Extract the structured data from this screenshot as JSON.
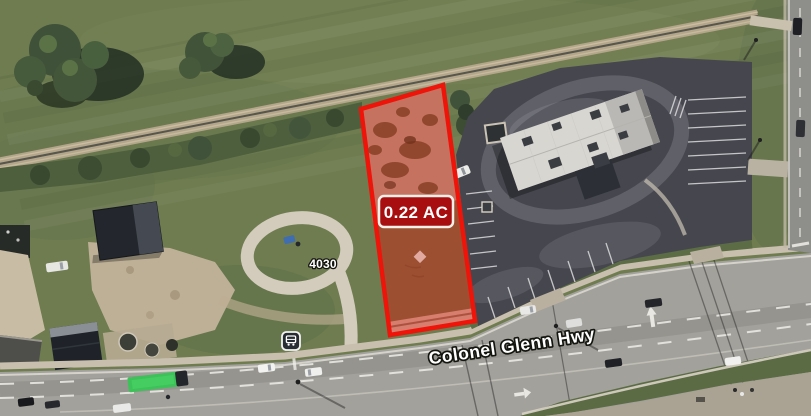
{
  "map": {
    "street_label": "Colonel Glenn Hwy",
    "address_label": "4030",
    "parcel": {
      "area_label": "0.22 AC"
    },
    "colors": {
      "parcel_outline": "#ee1409",
      "parcel_fill_tint": "rgba(237,28,17,0.18)",
      "area_label_bg": "#a80e10",
      "area_label_border": "#f3efe9",
      "area_label_text": "#ffffff"
    },
    "icons": [
      {
        "name": "bus-stop-icon"
      }
    ]
  }
}
